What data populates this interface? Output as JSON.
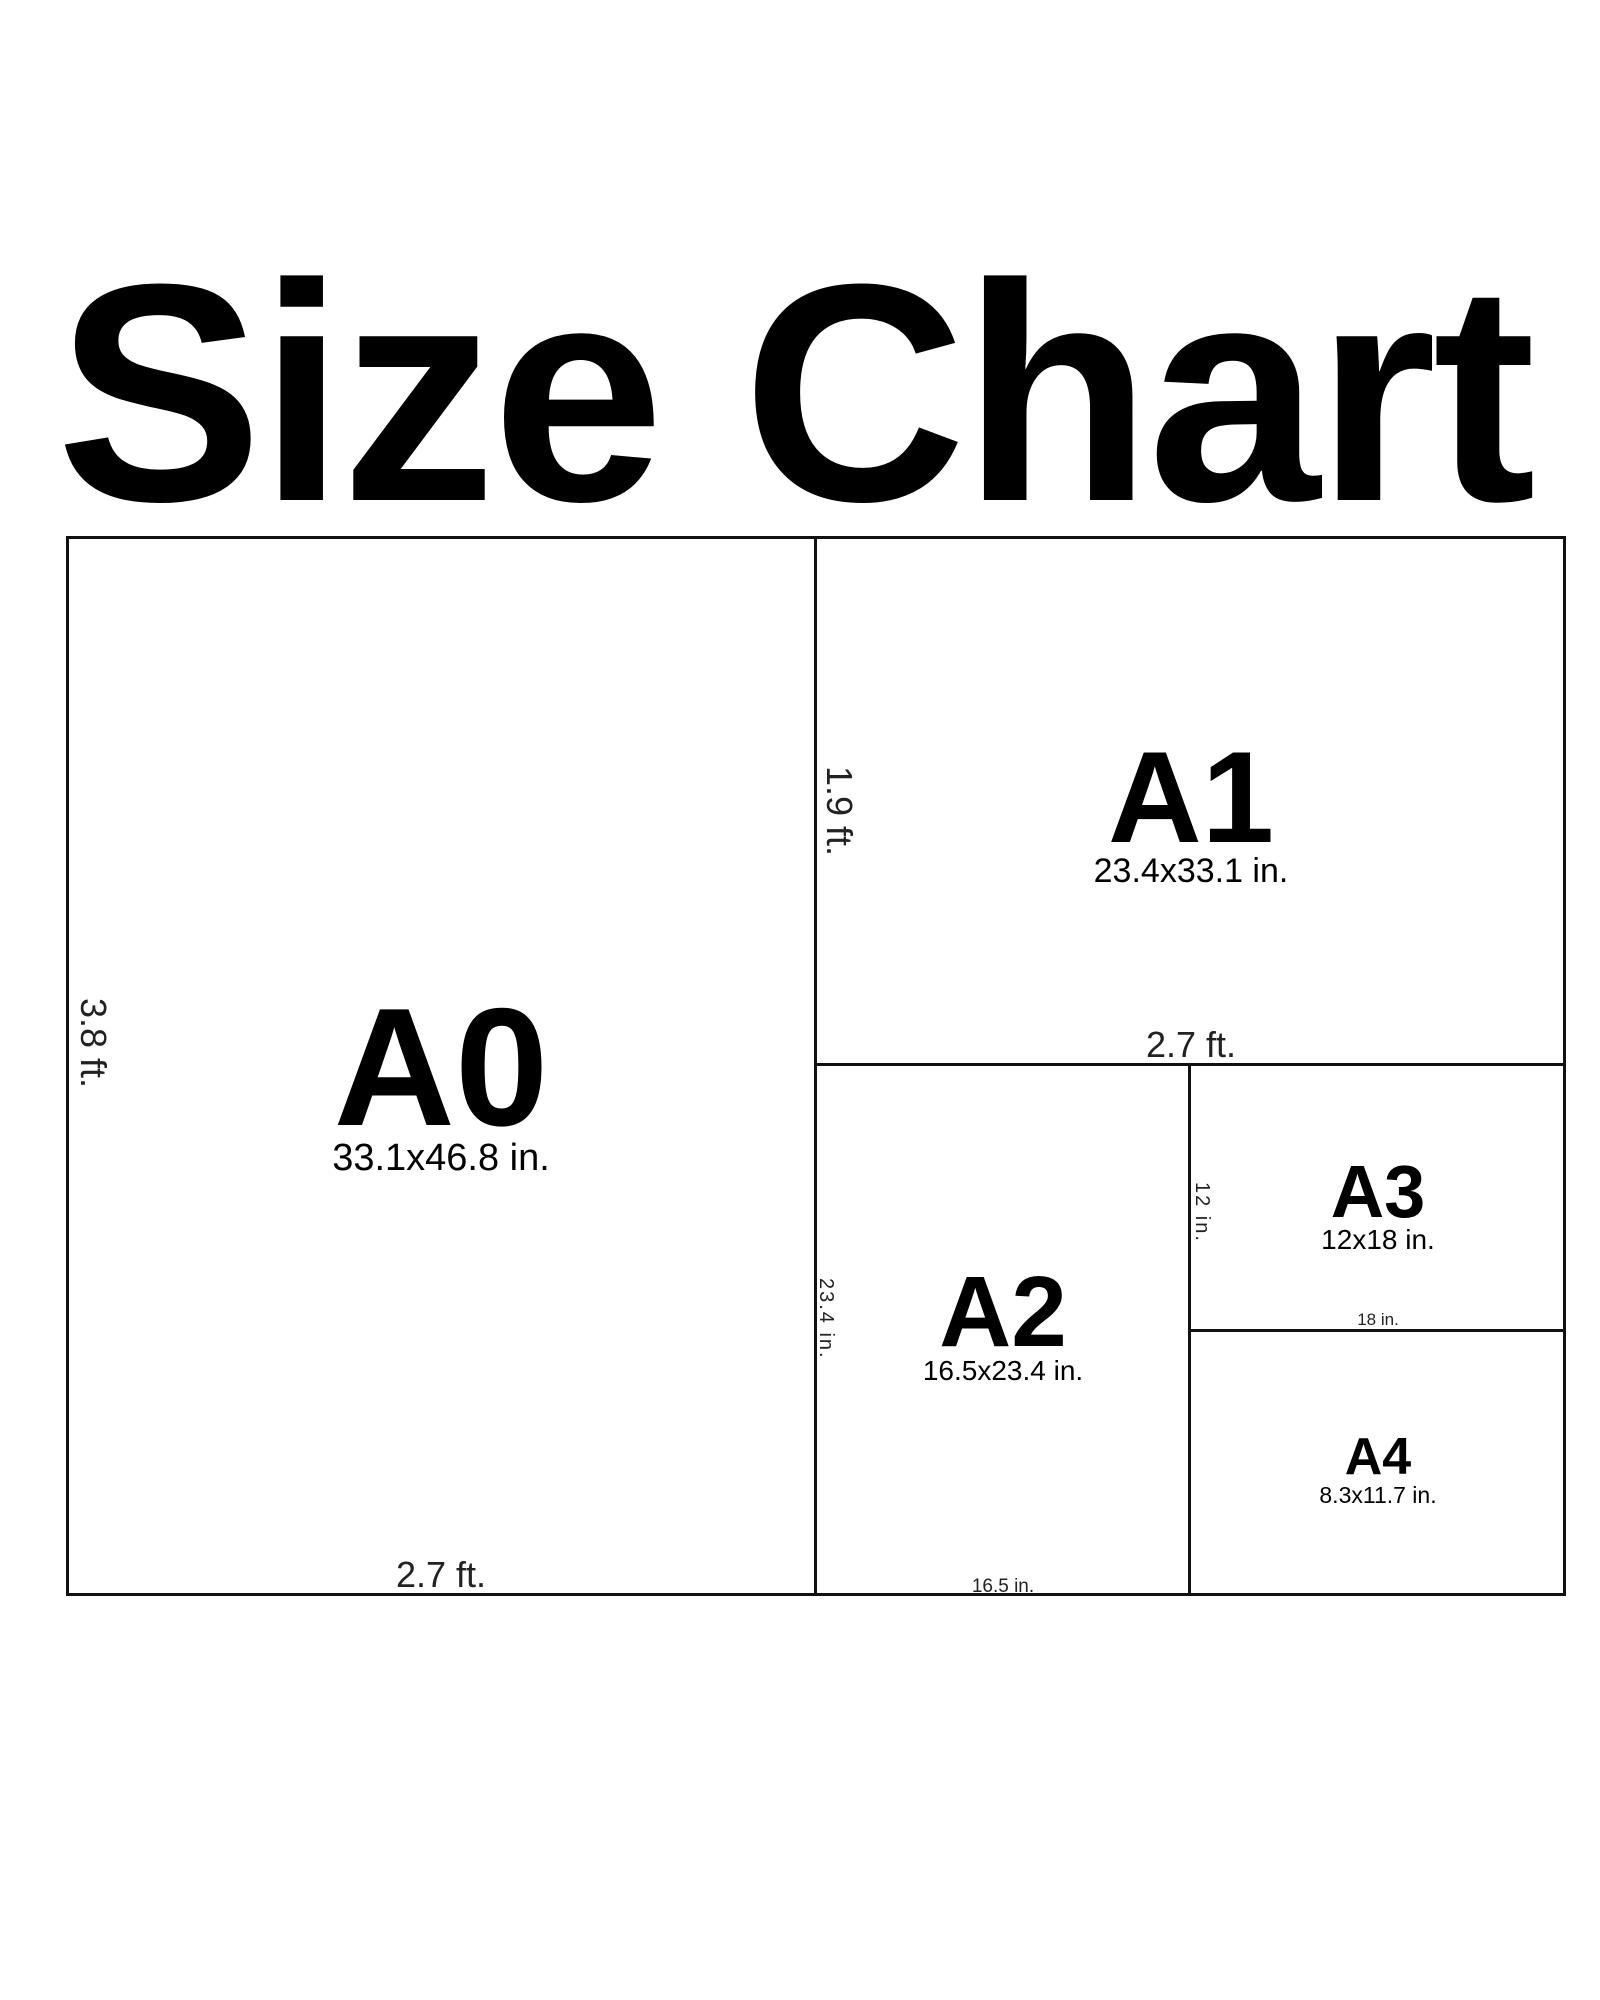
{
  "title": "Size Chart",
  "diagram": {
    "papers": [
      {
        "id": "a0",
        "label": "A0",
        "dimensions": "33.1x46.8 in.",
        "height_label": "3.8 ft.",
        "width_label": "2.7 ft."
      },
      {
        "id": "a1",
        "label": "A1",
        "dimensions": "23.4x33.1 in.",
        "height_label": "1.9 ft.",
        "width_label": "2.7 ft."
      },
      {
        "id": "a2",
        "label": "A2",
        "dimensions": "16.5x23.4 in.",
        "height_label": "23.4 in.",
        "width_label": "16.5 in."
      },
      {
        "id": "a3",
        "label": "A3",
        "dimensions": "12x18 in.",
        "height_label": "12 in.",
        "width_label": "18 in."
      },
      {
        "id": "a4",
        "label": "A4",
        "dimensions": "8.3x11.7 in."
      }
    ]
  },
  "colors": {
    "ink": "#000000",
    "line": "#111111",
    "dimension_text": "#222222",
    "background": "#ffffff"
  }
}
